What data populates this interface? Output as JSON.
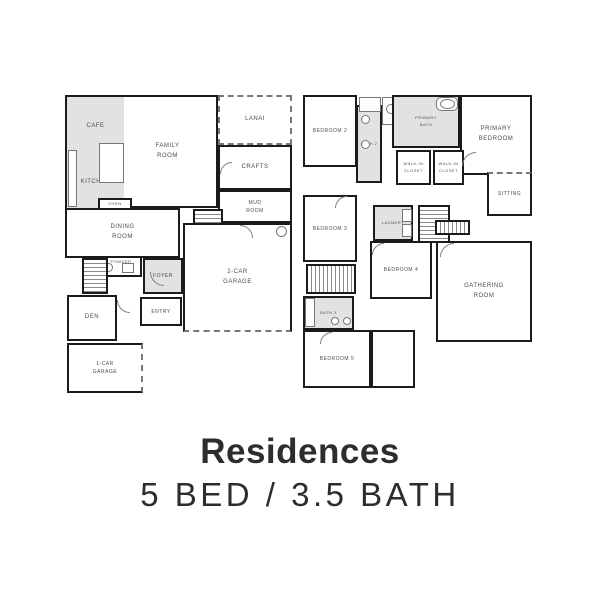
{
  "title": "Residences",
  "subtitle": "5 BED / 3.5 BATH",
  "colors": {
    "wall": "#1b1b1b",
    "shaded_room": "#e2e2e2",
    "room_label": "#4d4d4d",
    "heading_text": "#2d2d2d",
    "background": "#ffffff"
  },
  "floors": {
    "first": {
      "rooms": {
        "cafe": {
          "label": "CAFE"
        },
        "kitchen": {
          "label": "KITCHEN"
        },
        "oven": {
          "label": "OVEN"
        },
        "family_room": {
          "label": "FAMILY\nROOM"
        },
        "lanai": {
          "label": "LANAI"
        },
        "crafts": {
          "label": "CRAFTS"
        },
        "mud_room": {
          "label": "MUD\nROOM"
        },
        "dining_room": {
          "label": "DINING\nROOM"
        },
        "storage": {
          "label": "STORAGE"
        },
        "two_car_garage": {
          "label": "2-CAR\nGARAGE"
        },
        "powder": {
          "label": "POWDER"
        },
        "foyer": {
          "label": "FOYER"
        },
        "den": {
          "label": "DEN"
        },
        "entry": {
          "label": "ENTRY"
        },
        "one_car_garage": {
          "label": "1-CAR\nGARAGE"
        }
      }
    },
    "second": {
      "rooms": {
        "bedroom_2": {
          "label": "BEDROOM 2"
        },
        "bath_2": {
          "label": "BATH 2"
        },
        "primary_bath": {
          "label": "PRIMARY\nBATH"
        },
        "primary_bedroom": {
          "label": "PRIMARY\nBEDROOM"
        },
        "walk_in_closet_1": {
          "label": "WALK-IN\nCLOSET"
        },
        "walk_in_closet_2": {
          "label": "WALK-IN\nCLOSET"
        },
        "sitting": {
          "label": "SITTING"
        },
        "bedroom_3": {
          "label": "BEDROOM 3"
        },
        "laundry": {
          "label": "LAUNDRY"
        },
        "bedroom_4": {
          "label": "BEDROOM 4"
        },
        "gathering_room": {
          "label": "GATHERING\nROOM"
        },
        "bath_3": {
          "label": "BATH 3"
        },
        "bedroom_5": {
          "label": "BEDROOM 5"
        }
      }
    }
  }
}
